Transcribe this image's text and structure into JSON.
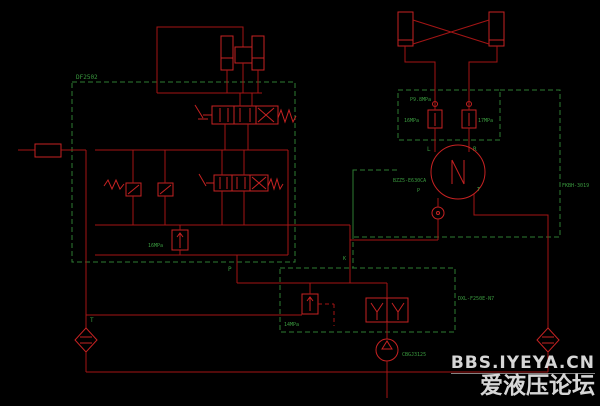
{
  "colors": {
    "background": "#000000",
    "line_red": "#a31515",
    "component_red": "#c62222",
    "dashed_green": "#2e7d32",
    "label_green": "#3a9a3f",
    "watermark_white": "#e7e7e7"
  },
  "labels": {
    "main_valve_block_model": "DF2502",
    "main_relief_pressure": "16MPa",
    "p_port": "P",
    "t_port": "T",
    "steering_block_pressure": "P9.8MPa",
    "steering_relief_left": "16MPa",
    "steering_relief_right": "17MPa",
    "port_l": "L",
    "port_r": "R",
    "steering_unit_model": "BZZ5-E630CA",
    "steering_p_port": "P",
    "steering_t_port": "T",
    "flow_amplifier_model": "FKBH-3019",
    "port_k": "K",
    "pilot_valve_model": "DXL-F250E-N7",
    "pilot_relief_pressure": "14MPa",
    "pump_model": "CBGJ3125"
  },
  "watermark": {
    "line1": "BBS.IYEYA.CN",
    "line2": "爱液压论坛"
  }
}
